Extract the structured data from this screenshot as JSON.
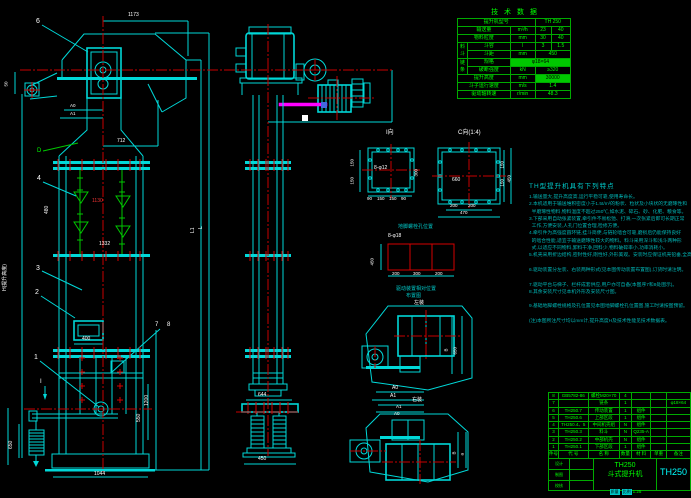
{
  "fv": {
    "d1173": "1173",
    "d712": "712",
    "a0": "A0",
    "a1": "A1",
    "d50": "50",
    "b6": "6",
    "vd": "D",
    "b4": "4",
    "d1130": "1130",
    "d480": "480",
    "d1332": "1332",
    "b3": "3",
    "b2": "2",
    "hlabel": "H(提升高度)",
    "d400": "400",
    "b1": "1",
    "b7": "7",
    "b8": "8",
    "si": "I",
    "d1200": "1200",
    "d550": "550",
    "d650": "650",
    "d1332b": "1332",
    "d1044": "1044",
    "l1": "L1",
    "l": "L"
  },
  "sv": {
    "d644": "644",
    "d450": "450"
  },
  "vi": {
    "label": "I向",
    "bolt": "8-φ12",
    "l150a": "150",
    "l150b": "150",
    "r300": "300",
    "b90a": "90",
    "b150a": "150",
    "b150b": "150",
    "b90b": "90"
  },
  "vc": {
    "label": "C向(1:4)",
    "c660": "660",
    "b200a": "200",
    "b200b": "200",
    "b470": "470",
    "r150a": "150",
    "r150b": "150",
    "r450": "450"
  },
  "an": {
    "title": "地脚螺栓孔位置",
    "bolt": "8-φ18",
    "d200a": "200",
    "d300": "300",
    "d200b": "200",
    "d450": "450"
  },
  "pa": {
    "t1": "驱动装置相对位置",
    "t2": "布置图",
    "lab": "左装",
    "a0": "A0",
    "a1": "A1",
    "b": "B",
    "h": "650"
  },
  "pb": {
    "lab": "右装",
    "a1": "A1",
    "a0": "A0",
    "b": "B",
    "a": "a"
  },
  "notes": {
    "title": "TH型提升机具有下列特点",
    "lines": [
      "1.输送量大,提升高度高,运行平稳可靠,使用寿命长。",
      "2.本机适用于输送堆积密度小于1.5t/m³的粉状、粒状及小块状的无磨琢性和",
      "  半磨琢性物料,物料温度不超过250℃,如水泥、碎石、砂、化肥、粮食等。",
      "3.下部采用自动张紧装置,牵引件不易松弛、打滑,一次张紧后即可长期正常",
      "  工作,方便安装,人孔门位置合理,检修方便。",
      "4.牵引件为高强度圆环链,挂斗简便,与链轮啮合可靠,磨损后仍能保持良好",
      "  的啮合性能,适宜于输送磨琢性较大的物料。料斗采用深斗和浅斗两种形",
      "  式,以适应不同物料,卸料干净,回料少,物料破碎率小,功率消耗小。",
      "5.机壳采用折边结构,密封性好,刚性好,外形美观。安装时应保证机壳铅垂,全高范围内垂直误差不大于10mm。",
      "",
      "6.驱动装置分左装、右装两种形式(见本图传动装置布置图),订货时请注明。",
      "",
      "7.驱动平台与梯子、栏杆成套供应,用户亦可自备(本图序7和8处图示)。",
      "8.其余安装尺寸见本机外形及安装尺寸图。",
      "",
      "9.基础地脚螺栓规格及孔位置见本图地脚螺栓孔位置图,施工时请按图预留。",
      "",
      "(注)本图所注尺寸均以mm计,提升高度H及技术性能见技术数据表。"
    ]
  },
  "tech": {
    "title": "技 术 数 据",
    "r1l": "提升机型号",
    "r1v": "TH 250",
    "r2l": "输送量",
    "r2u": "m³/h",
    "r2a": "23",
    "r2b": "40",
    "r3l": "物料粒度",
    "r3u": "mm",
    "r3a": "30",
    "r3b": "40",
    "g1": "料斗",
    "r4l": "斗容",
    "r4u": "l",
    "r4a": "3",
    "r4b": "1.5",
    "r5l": "斗距",
    "r5u": "mm",
    "r5v": "450",
    "g2": "链条",
    "r6l": "规格",
    "r6v": "φ18×64",
    "r7l": "破断强度",
    "r7u": "kN",
    "r7v": "≥320",
    "r8l": "提升高度",
    "r8u": "mm",
    "r8v": "30000",
    "r9l": "斗子运行速度",
    "r9u": "m/s",
    "r9v": "1.4",
    "r10l": "驱动轴转速",
    "r10u": "r/min",
    "r10v": "48.3"
  },
  "bom": {
    "h": [
      "件号",
      "代 号",
      "名 称",
      "数量",
      "材 料",
      "单重",
      "备注"
    ],
    "rows": [
      [
        "8",
        "GB5782-86",
        "螺栓M20×70",
        "4",
        "",
        "",
        ""
      ],
      [
        "7",
        "",
        "链条",
        "1",
        "",
        "",
        "φ18×64"
      ],
      [
        "6",
        "TH250.7",
        "传动装置",
        "1",
        "组件",
        "",
        ""
      ],
      [
        "5",
        "TH250.6",
        "上部区段",
        "1",
        "组件",
        "",
        ""
      ],
      [
        "4",
        "TH250.4、5",
        "中间机壳组",
        "N",
        "组件",
        "",
        ""
      ],
      [
        "3",
        "TH250.3",
        "料斗",
        "N",
        "Q235-A",
        "",
        ""
      ],
      [
        "2",
        "TH250.2",
        "中部机壳",
        "N",
        "组件",
        "",
        ""
      ],
      [
        "1",
        "TH250.1",
        "下部区段",
        "1",
        "组件",
        "",
        ""
      ]
    ]
  },
  "tb": {
    "model": "TH250",
    "name": "斗式提升机",
    "dno": "TH250",
    "c1": "质量",
    "c2": "比例",
    "scale": "1:25",
    "l1": "设计",
    "l2": "制图",
    "l3": "校核"
  }
}
